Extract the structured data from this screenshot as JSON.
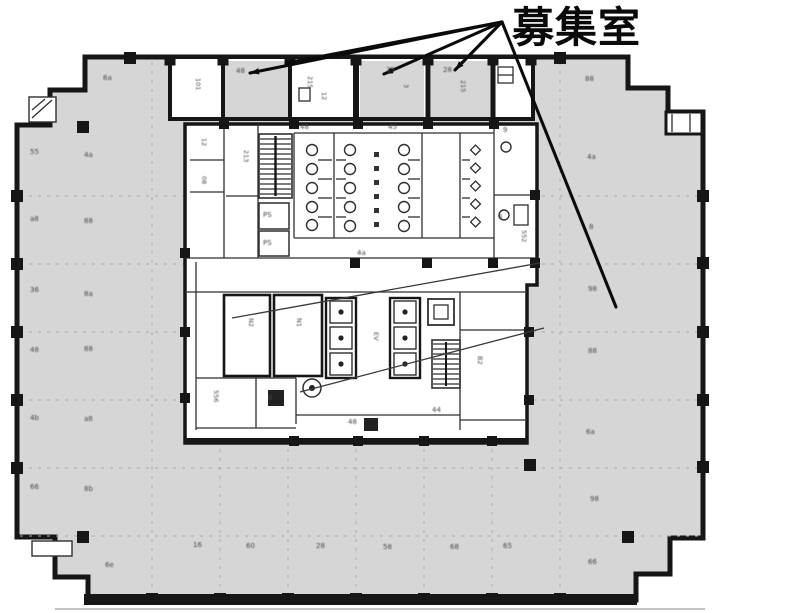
{
  "title": {
    "text": "募集室"
  },
  "colors": {
    "paper": "#ffffff",
    "floor": "#d6d6d6",
    "wall": "#161616",
    "thin": "#2f2f2f",
    "dash": "#a9a9a9",
    "annot": "#0b0b0b",
    "smudge": "#474747"
  },
  "annotation": {
    "apex": {
      "x": 502,
      "y": 22
    },
    "leader_targets": [
      {
        "name": "leased-room-1",
        "x": 250,
        "y": 73,
        "arrow": true
      },
      {
        "name": "leased-room-1b",
        "x": 286,
        "y": 63,
        "arrow": true
      },
      {
        "name": "leased-room-2",
        "x": 384,
        "y": 74,
        "arrow": true
      },
      {
        "name": "leased-room-3",
        "x": 455,
        "y": 70,
        "arrow": true
      },
      {
        "name": "main-open-floor",
        "x": 616,
        "y": 307,
        "arrow": false
      }
    ],
    "internal_lines": [
      {
        "x1": 232,
        "y1": 318,
        "x2": 540,
        "y2": 263
      },
      {
        "x1": 300,
        "y1": 392,
        "x2": 544,
        "y2": 328
      }
    ]
  },
  "illegible_marks": {
    "horizontal": [
      {
        "x": 103,
        "y": 80,
        "t": "6a"
      },
      {
        "x": 30,
        "y": 154,
        "t": "55"
      },
      {
        "x": 84,
        "y": 157,
        "t": "4a"
      },
      {
        "x": 30,
        "y": 221,
        "t": "a8"
      },
      {
        "x": 84,
        "y": 223,
        "t": "88"
      },
      {
        "x": 30,
        "y": 292,
        "t": "36"
      },
      {
        "x": 84,
        "y": 296,
        "t": "8a"
      },
      {
        "x": 30,
        "y": 352,
        "t": "48"
      },
      {
        "x": 84,
        "y": 351,
        "t": "88"
      },
      {
        "x": 30,
        "y": 420,
        "t": "4b"
      },
      {
        "x": 84,
        "y": 421,
        "t": "a8"
      },
      {
        "x": 30,
        "y": 489,
        "t": "66"
      },
      {
        "x": 84,
        "y": 491,
        "t": "8b"
      },
      {
        "x": 105,
        "y": 567,
        "t": "6e"
      },
      {
        "x": 193,
        "y": 547,
        "t": "16"
      },
      {
        "x": 246,
        "y": 548,
        "t": "60"
      },
      {
        "x": 316,
        "y": 548,
        "t": "28"
      },
      {
        "x": 383,
        "y": 549,
        "t": "58"
      },
      {
        "x": 450,
        "y": 549,
        "t": "68"
      },
      {
        "x": 503,
        "y": 548,
        "t": "65"
      },
      {
        "x": 585,
        "y": 81,
        "t": "88"
      },
      {
        "x": 587,
        "y": 159,
        "t": "4a"
      },
      {
        "x": 589,
        "y": 229,
        "t": "8"
      },
      {
        "x": 588,
        "y": 291,
        "t": "98"
      },
      {
        "x": 588,
        "y": 353,
        "t": "88"
      },
      {
        "x": 586,
        "y": 434,
        "t": "6a"
      },
      {
        "x": 590,
        "y": 501,
        "t": "98"
      },
      {
        "x": 588,
        "y": 564,
        "t": "66"
      },
      {
        "x": 236,
        "y": 73,
        "t": "48"
      },
      {
        "x": 386,
        "y": 72,
        "t": "35"
      },
      {
        "x": 443,
        "y": 72,
        "t": "28"
      },
      {
        "x": 503,
        "y": 132,
        "t": "9"
      },
      {
        "x": 498,
        "y": 219,
        "t": "6"
      },
      {
        "x": 263,
        "y": 217,
        "t": "PS"
      },
      {
        "x": 263,
        "y": 245,
        "t": "PS"
      },
      {
        "x": 300,
        "y": 129,
        "t": "48"
      },
      {
        "x": 388,
        "y": 129,
        "t": "45"
      },
      {
        "x": 268,
        "y": 400,
        "t": "8"
      },
      {
        "x": 432,
        "y": 412,
        "t": "44"
      },
      {
        "x": 348,
        "y": 424,
        "t": "48"
      },
      {
        "x": 357,
        "y": 255,
        "t": "4a"
      }
    ],
    "vertical": [
      {
        "x": 196,
        "y": 78,
        "t": "101"
      },
      {
        "x": 308,
        "y": 76,
        "t": "215"
      },
      {
        "x": 322,
        "y": 92,
        "t": "12"
      },
      {
        "x": 404,
        "y": 84,
        "t": "3"
      },
      {
        "x": 461,
        "y": 80,
        "t": "215"
      },
      {
        "x": 202,
        "y": 138,
        "t": "12"
      },
      {
        "x": 202,
        "y": 176,
        "t": "08"
      },
      {
        "x": 244,
        "y": 150,
        "t": "213"
      },
      {
        "x": 249,
        "y": 318,
        "t": "N2"
      },
      {
        "x": 297,
        "y": 318,
        "t": "N1"
      },
      {
        "x": 374,
        "y": 332,
        "t": "EV"
      },
      {
        "x": 214,
        "y": 390,
        "t": "556"
      },
      {
        "x": 443,
        "y": 352,
        "t": "2"
      },
      {
        "x": 478,
        "y": 356,
        "t": "B2"
      },
      {
        "x": 522,
        "y": 230,
        "t": "552"
      }
    ]
  }
}
